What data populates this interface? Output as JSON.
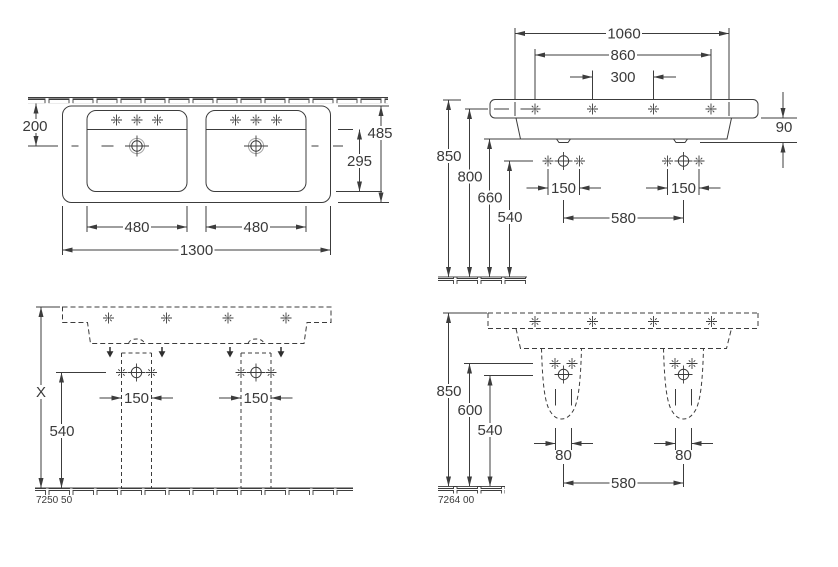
{
  "plan_view": {
    "dims": {
      "wall_to_drain": "200",
      "overall_depth": "485",
      "bowl_depth": "295",
      "basin_width_left": "480",
      "basin_width_right": "480",
      "overall_width": "1300"
    }
  },
  "wall_view": {
    "dims": {
      "fixing_width": "1060",
      "tap_outer_span": "860",
      "tap_inner_span": "300",
      "rim_thickness": "90",
      "rim_from_floor": "850",
      "centerline_from_floor": "800",
      "underside_from_floor": "660",
      "connection_from_floor": "540",
      "connection_pair_left": "150",
      "connection_pair_right": "150",
      "connection_spread": "580"
    }
  },
  "pedestal_front_view": {
    "dims": {
      "height_reference": "X",
      "connection_from_floor": "540",
      "pedestal_width_left": "150",
      "pedestal_width_right": "150"
    },
    "model": "7250 50"
  },
  "pedestal_side_view": {
    "dims": {
      "rim_from_floor": "850",
      "upper_connection_from_floor": "600",
      "lower_connection_from_floor": "540",
      "outlet_width_left": "80",
      "outlet_width_right": "80",
      "outlet_spread": "580"
    },
    "model": "7264 00"
  }
}
